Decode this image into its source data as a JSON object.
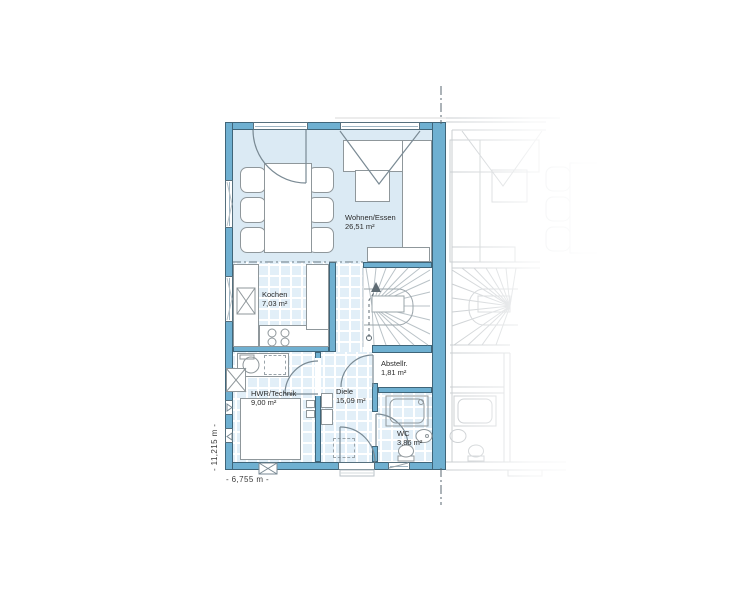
{
  "plan": {
    "rooms": [
      {
        "name": "Wohnen/Essen",
        "area": "26,51 m²"
      },
      {
        "name": "Kochen",
        "area": "7,03 m²"
      },
      {
        "name": "HWR/Technik",
        "area": "9,00 m²"
      },
      {
        "name": "Diele",
        "area": "15,09 m²"
      },
      {
        "name": "Abstellr.",
        "area": "1,81 m²"
      },
      {
        "name": "WC",
        "area": "3,86 m²"
      }
    ],
    "dimensions": {
      "height_label": "- 11,215 m -",
      "width_label": "- 6,755 m -"
    }
  },
  "colors": {
    "wall": "#6FB0D1",
    "wall_edge": "#3F6579",
    "floor": "#DBEAF4",
    "tile": "#E2EFF8",
    "furniture_edge": "#8F979B",
    "line": "#7A8A94",
    "neighbor": "#C9CDD0",
    "text": "#2B2B2B",
    "centerline": "#5A6770"
  }
}
